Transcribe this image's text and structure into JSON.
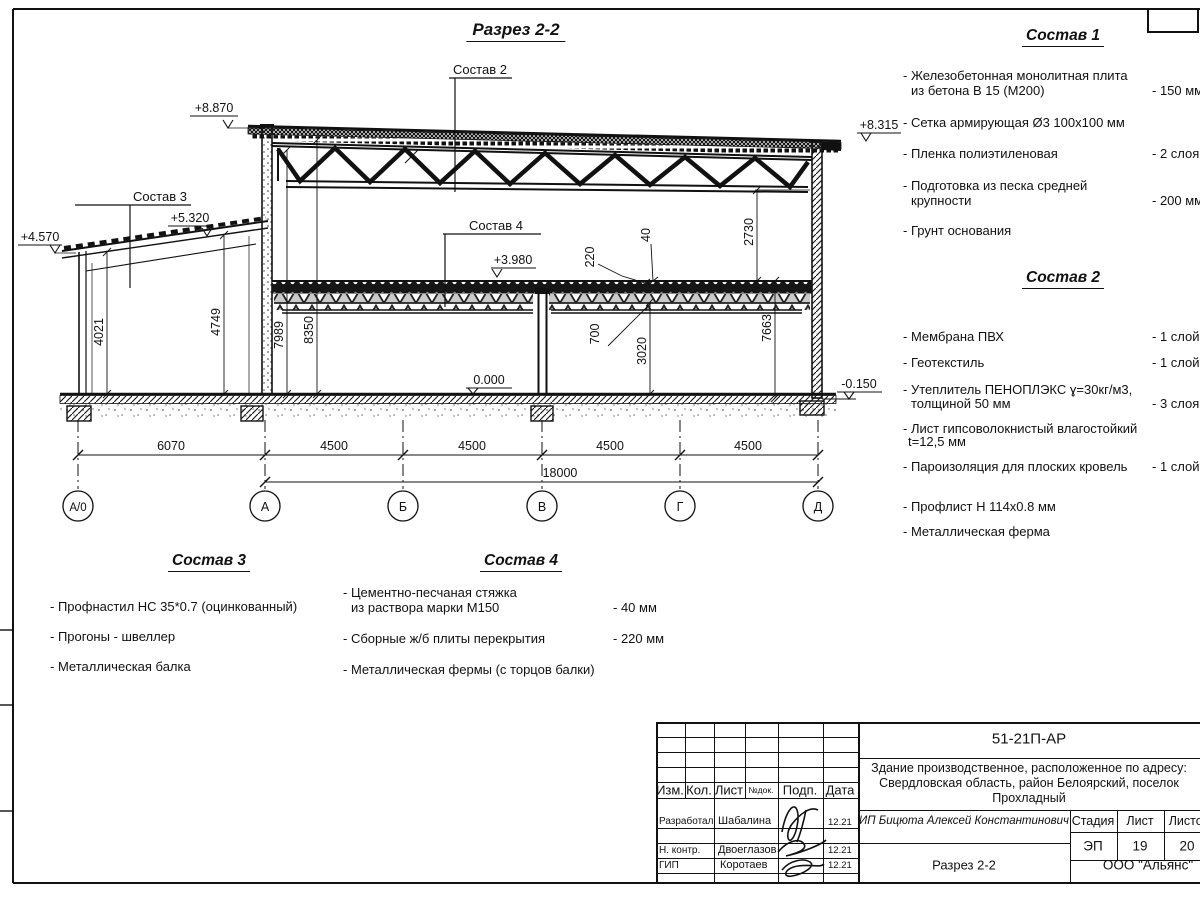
{
  "drawing": {
    "title": "Разрез 2-2",
    "callouts": {
      "c2": "Состав 2",
      "c3": "Состав 3",
      "c4": "Состав 4"
    },
    "levels": {
      "top_left": "+8.870",
      "top_right": "+8.315",
      "leanto_high": "+5.320",
      "leanto_low": "+4.570",
      "mid_floor": "+3.980",
      "zero": "0.000",
      "minus": "-0.150"
    },
    "dims_vertical": {
      "d4021": "4021",
      "d4749": "4749",
      "d7989": "7989",
      "d8350": "8350",
      "d2730": "2730",
      "d7663": "7663",
      "d220": "220",
      "d40": "40",
      "d700": "700",
      "d3020": "3020"
    },
    "dims_bottom": {
      "seg1": "6070",
      "seg2": "4500",
      "seg3": "4500",
      "seg4": "4500",
      "seg5": "4500",
      "total": "18000"
    },
    "axes": {
      "a0": "А/0",
      "a1": "А",
      "a2": "Б",
      "a3": "В",
      "a4": "Г",
      "a5": "Д"
    }
  },
  "lists": {
    "s1": {
      "title": "Состав 1",
      "items": [
        {
          "l1": "- Железобетонная  монолитная плита",
          "l2": "из бетона В 15 (М200)",
          "qty": "- 150 мм"
        },
        {
          "l1": "- Сетка армирующая Ø3 100x100 мм",
          "l2": "",
          "qty": ""
        },
        {
          "l1": "- Пленка полиэтиленовая",
          "l2": "",
          "qty": "-  2 слоя"
        },
        {
          "l1": "- Подготовка из песка средней",
          "l2": "крупности",
          "qty": "- 200 мм"
        },
        {
          "l1": "- Грунт основания",
          "l2": "",
          "qty": ""
        }
      ]
    },
    "s2": {
      "title": "Состав 2",
      "items": [
        {
          "l1": "- Мембрана ПВХ",
          "l2": "",
          "qty": "- 1 слой"
        },
        {
          "l1": "- Геотекстиль",
          "l2": "",
          "qty": "- 1 слой"
        },
        {
          "l1": "- Утеплитель ПЕНОПЛЭКС ɣ=30кг/м3,",
          "l2": "толщиной 50 мм",
          "qty": "- 3 слоя"
        },
        {
          "l1": "- Лист гипсоволокнистый влагостойкий",
          "l2": "t=12,5 мм",
          "qty": ""
        },
        {
          "l1": "- Пароизоляция для плоских кровель",
          "l2": "",
          "qty": "- 1 слой"
        },
        {
          "l1": "- Профлист Н 114x0.8 мм",
          "l2": "",
          "qty": ""
        },
        {
          "l1": "- Металлическая ферма",
          "l2": "",
          "qty": ""
        }
      ]
    },
    "s3": {
      "title": "Состав 3",
      "items": [
        {
          "l1": "- Профнастил НС 35*0.7 (оцинкованный)"
        },
        {
          "l1": "- Прогоны - швеллер"
        },
        {
          "l1": "- Металлическая балка"
        }
      ]
    },
    "s4": {
      "title": "Состав 4",
      "items": [
        {
          "l1": "- Цементно-песчаная стяжка",
          "l2": "из раствора марки М150",
          "qty": "- 40 мм"
        },
        {
          "l1": "- Сборные ж/б плиты перекрытия",
          "l2": "",
          "qty": "- 220 мм"
        },
        {
          "l1": "- Металлическая фермы (с торцов балки)",
          "l2": "",
          "qty": ""
        }
      ]
    }
  },
  "titleblock": {
    "doc_number": "51-21П-АР",
    "address_line1": "Здание производственное, расположенное по адресу:",
    "address_line2": "Свердловская область, район Белоярский, поселок",
    "address_line3": "Прохладный",
    "header": {
      "izm": "Изм.",
      "kol": "Кол.",
      "list": "Лист",
      "ndok": "№док.",
      "podp": "Подп.",
      "data": "Дата"
    },
    "rows": [
      {
        "role": "Разработал",
        "name": "Шабалина",
        "date": "12.21"
      },
      {
        "role": "Н. контр.",
        "name": "Двоеглазов",
        "date": "12.21"
      },
      {
        "role": "ГИП",
        "name": "Коротаев",
        "date": "12.21"
      }
    ],
    "designer": "ИП Бицюта Алексей Константинович",
    "stage_label": "Стадия",
    "sheet_label": "Лист",
    "sheets_label": "Листов",
    "stage": "ЭП",
    "sheet": "19",
    "sheets": "20",
    "section_name": "Разрез 2-2",
    "company": "ООО \"Альянс\""
  }
}
